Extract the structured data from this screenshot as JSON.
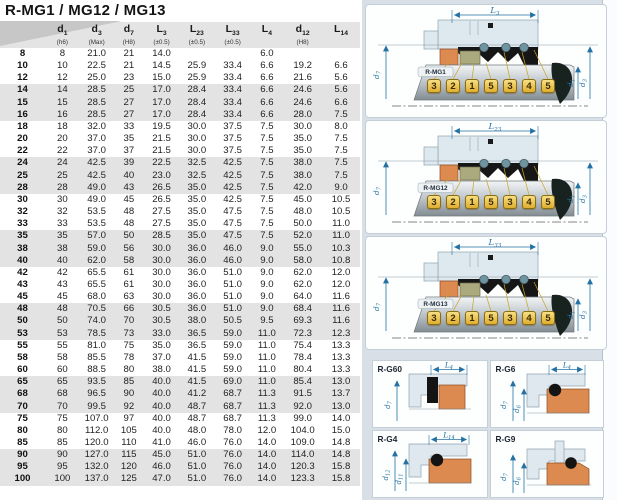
{
  "title": "R-MG1 / MG12 / MG13",
  "colors": {
    "accent_blue": "#2471a3",
    "panel_bg": "#d8dfe7",
    "row_band": "#e3e3e3",
    "seat_orange": "#dd8a50",
    "marker_yellow": "#e9b93a"
  },
  "table": {
    "columns": [
      {
        "main": "",
        "sub": "",
        "note": ""
      },
      {
        "main": "d",
        "sub": "1",
        "note": "(h6)"
      },
      {
        "main": "d",
        "sub": "3",
        "note": "(Max)"
      },
      {
        "main": "d",
        "sub": "7",
        "note": "(H8)"
      },
      {
        "main": "L",
        "sub": "3",
        "note": "(±0.5)"
      },
      {
        "main": "L",
        "sub": "23",
        "note": "(±0.5)"
      },
      {
        "main": "L",
        "sub": "33",
        "note": "(±0.5)"
      },
      {
        "main": "L",
        "sub": "4",
        "note": ""
      },
      {
        "main": "d",
        "sub": "12",
        "note": "(H8)"
      },
      {
        "main": "L",
        "sub": "14",
        "note": ""
      }
    ],
    "rows": [
      [
        "8",
        "8",
        "21.0",
        "21",
        "14.0",
        "",
        "",
        "6.0",
        "",
        ""
      ],
      [
        "10",
        "10",
        "22.5",
        "21",
        "14.5",
        "25.9",
        "33.4",
        "6.6",
        "19.2",
        "6.6"
      ],
      [
        "12",
        "12",
        "25.0",
        "23",
        "15.0",
        "25.9",
        "33.4",
        "6.6",
        "21.6",
        "5.6"
      ],
      [
        "14",
        "14",
        "28.5",
        "25",
        "17.0",
        "28.4",
        "33.4",
        "6.6",
        "24.6",
        "5.6"
      ],
      [
        "15",
        "15",
        "28.5",
        "27",
        "17.0",
        "28.4",
        "33.4",
        "6.6",
        "24.6",
        "6.6"
      ],
      [
        "16",
        "16",
        "28.5",
        "27",
        "17.0",
        "28.4",
        "33.4",
        "6.6",
        "28.0",
        "7.5"
      ],
      [
        "18",
        "18",
        "32.0",
        "33",
        "19.5",
        "30.0",
        "37.5",
        "7.5",
        "30.0",
        "8.0"
      ],
      [
        "20",
        "20",
        "37.0",
        "35",
        "21.5",
        "30.0",
        "37.5",
        "7.5",
        "35.0",
        "7.5"
      ],
      [
        "22",
        "22",
        "37.0",
        "37",
        "21.5",
        "30.0",
        "37.5",
        "7.5",
        "35.0",
        "7.5"
      ],
      [
        "24",
        "24",
        "42.5",
        "39",
        "22.5",
        "32.5",
        "42.5",
        "7.5",
        "38.0",
        "7.5"
      ],
      [
        "25",
        "25",
        "42.5",
        "40",
        "23.0",
        "32.5",
        "42.5",
        "7.5",
        "38.0",
        "7.5"
      ],
      [
        "28",
        "28",
        "49.0",
        "43",
        "26.5",
        "35.0",
        "42.5",
        "7.5",
        "42.0",
        "9.0"
      ],
      [
        "30",
        "30",
        "49.0",
        "45",
        "26.5",
        "35.0",
        "42.5",
        "7.5",
        "45.0",
        "10.5"
      ],
      [
        "32",
        "32",
        "53.5",
        "48",
        "27.5",
        "35.0",
        "47.5",
        "7.5",
        "48.0",
        "10.5"
      ],
      [
        "33",
        "33",
        "53.5",
        "48",
        "27.5",
        "35.0",
        "47.5",
        "7.5",
        "50.0",
        "11.0"
      ],
      [
        "35",
        "35",
        "57.0",
        "50",
        "28.5",
        "35.0",
        "47.5",
        "7.5",
        "52.0",
        "11.0"
      ],
      [
        "38",
        "38",
        "59.0",
        "56",
        "30.0",
        "36.0",
        "46.0",
        "9.0",
        "55.0",
        "10.3"
      ],
      [
        "40",
        "40",
        "62.0",
        "58",
        "30.0",
        "36.0",
        "46.0",
        "9.0",
        "58.0",
        "10.8"
      ],
      [
        "42",
        "42",
        "65.5",
        "61",
        "30.0",
        "36.0",
        "51.0",
        "9.0",
        "62.0",
        "12.0"
      ],
      [
        "43",
        "43",
        "65.5",
        "61",
        "30.0",
        "36.0",
        "51.0",
        "9.0",
        "62.0",
        "12.0"
      ],
      [
        "45",
        "45",
        "68.0",
        "63",
        "30.0",
        "36.0",
        "51.0",
        "9.0",
        "64.0",
        "11.6"
      ],
      [
        "48",
        "48",
        "70.5",
        "66",
        "30.5",
        "36.0",
        "51.0",
        "9.0",
        "68.4",
        "11.6"
      ],
      [
        "50",
        "50",
        "74.0",
        "70",
        "30.5",
        "38.0",
        "50.5",
        "9.5",
        "69.3",
        "11.6"
      ],
      [
        "53",
        "53",
        "78.5",
        "73",
        "33.0",
        "36.5",
        "59.0",
        "11.0",
        "72.3",
        "12.3"
      ],
      [
        "55",
        "55",
        "81.0",
        "75",
        "35.0",
        "36.5",
        "59.0",
        "11.0",
        "75.4",
        "13.3"
      ],
      [
        "58",
        "58",
        "85.5",
        "78",
        "37.0",
        "41.5",
        "59.0",
        "11.0",
        "78.4",
        "13.3"
      ],
      [
        "60",
        "60",
        "88.5",
        "80",
        "38.0",
        "41.5",
        "59.0",
        "11.0",
        "80.4",
        "13.3"
      ],
      [
        "65",
        "65",
        "93.5",
        "85",
        "40.0",
        "41.5",
        "69.0",
        "11.0",
        "85.4",
        "13.0"
      ],
      [
        "68",
        "68",
        "96.5",
        "90",
        "40.0",
        "41.2",
        "68.7",
        "11.3",
        "91.5",
        "13.7"
      ],
      [
        "70",
        "70",
        "99.5",
        "92",
        "40.0",
        "48.7",
        "68.7",
        "11.3",
        "92.0",
        "13.0"
      ],
      [
        "75",
        "75",
        "107.0",
        "97",
        "40.0",
        "48.7",
        "68.7",
        "11.3",
        "99.0",
        "14.0"
      ],
      [
        "80",
        "80",
        "112.0",
        "105",
        "40.0",
        "48.0",
        "78.0",
        "12.0",
        "104.0",
        "15.0"
      ],
      [
        "85",
        "85",
        "120.0",
        "110",
        "41.0",
        "46.0",
        "76.0",
        "14.0",
        "109.0",
        "14.8"
      ],
      [
        "90",
        "90",
        "127.0",
        "115",
        "45.0",
        "51.0",
        "76.0",
        "14.0",
        "114.0",
        "14.8"
      ],
      [
        "95",
        "95",
        "132.0",
        "120",
        "46.0",
        "51.0",
        "76.0",
        "14.0",
        "120.3",
        "15.8"
      ],
      [
        "100",
        "100",
        "137.0",
        "125",
        "47.0",
        "51.0",
        "76.0",
        "14.0",
        "123.3",
        "15.8"
      ]
    ]
  },
  "diagrams": [
    {
      "name": "R-MG1",
      "dim": {
        "main": "L",
        "sub": "3"
      },
      "left_dim": {
        "main": "d",
        "sub": "7"
      },
      "right_dim_inner": {
        "main": "d",
        "sub": "1"
      },
      "right_dim_outer": {
        "main": "d",
        "sub": "3"
      },
      "sequence": [
        "3",
        "2",
        "1",
        "5",
        "3",
        "4",
        "5"
      ]
    },
    {
      "name": "R-MG12",
      "dim": {
        "main": "L",
        "sub": "23"
      },
      "left_dim": {
        "main": "d",
        "sub": "7"
      },
      "right_dim_inner": {
        "main": "d",
        "sub": "1"
      },
      "right_dim_outer": {
        "main": "d",
        "sub": "3"
      },
      "sequence": [
        "3",
        "2",
        "1",
        "5",
        "3",
        "4",
        "5"
      ]
    },
    {
      "name": "R-MG13",
      "dim": {
        "main": "L",
        "sub": "33"
      },
      "left_dim": {
        "main": "d",
        "sub": "7"
      },
      "right_dim_inner": {
        "main": "d",
        "sub": "1"
      },
      "right_dim_outer": {
        "main": "d",
        "sub": "3"
      },
      "sequence": [
        "3",
        "2",
        "1",
        "5",
        "3",
        "4",
        "5"
      ]
    }
  ],
  "detail_panels": [
    {
      "name": "R-G60",
      "dim": {
        "main": "L",
        "sub": "4"
      },
      "dims": [
        {
          "main": "d",
          "sub": "7"
        }
      ]
    },
    {
      "name": "R-G6",
      "dim": {
        "main": "L",
        "sub": "4"
      },
      "dims": [
        {
          "main": "d",
          "sub": "7"
        },
        {
          "main": "d",
          "sub": "6"
        }
      ]
    },
    {
      "name": "R-G4",
      "dim": {
        "main": "L",
        "sub": "14"
      },
      "dims": [
        {
          "main": "d",
          "sub": "12"
        },
        {
          "main": "d",
          "sub": "11"
        }
      ]
    },
    {
      "name": "R-G9",
      "dims": [
        {
          "main": "d",
          "sub": "7"
        },
        {
          "main": "d",
          "sub": "6"
        }
      ]
    }
  ]
}
